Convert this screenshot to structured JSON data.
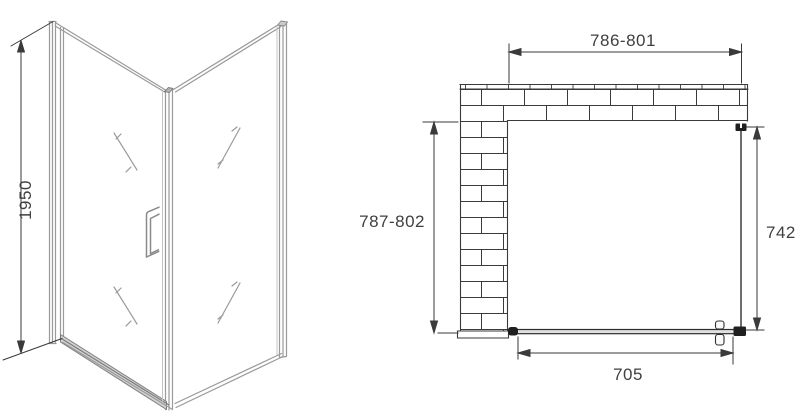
{
  "drawing": {
    "perspective_view": {
      "height_label": "1950"
    },
    "plan_view": {
      "top_width_label": "786-801",
      "left_depth_label": "787-802",
      "right_glass_label": "742",
      "bottom_door_label": "705"
    },
    "colors": {
      "plan_line": "#3a3a3a",
      "profile_line": "#9a9a9a",
      "text": "#3f3f3f",
      "fitting_black": "#1f1f1f"
    }
  }
}
